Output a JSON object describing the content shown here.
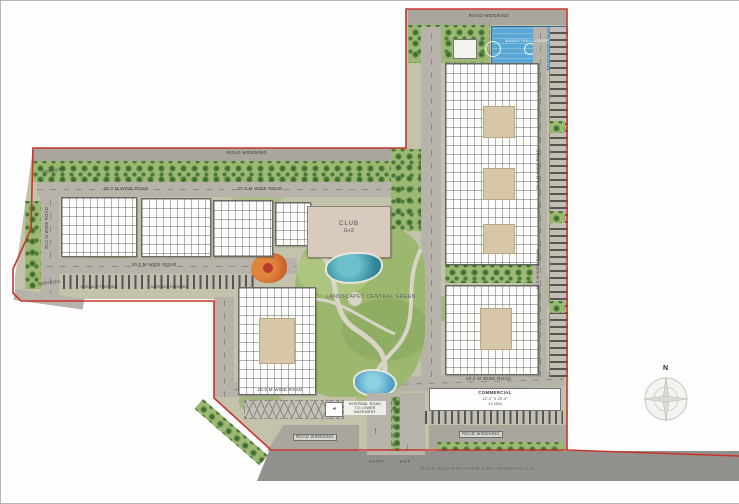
{
  "labels": {
    "road_widening_top": "ROAD WIDENING",
    "road_widening_left": "ROAD WIDENING",
    "road_widening_bottom_left": "ROAD WIDENING",
    "road_widening_bottom_right": "ROAD WIDENING",
    "road_widening_note": "ROAD WIDENING FROM SIDE OWNER'S LAND",
    "basketball_court": "BASKETBALL COURT",
    "services_top": "SERVICES",
    "services_bottom": "SERVICES",
    "club_name": "CLUB",
    "club_floors": "G+2",
    "central_green": "LANDSCAPED CENTRAL GREEN",
    "commercial_title": "COMMERCIAL",
    "commercial_size": "12'-0\" X 29'-0\"",
    "commercial_units": "12 NOs",
    "entry": "ENTRY",
    "exit": "EXIT",
    "internal_ramp_l1": "INTERNAL ROAD",
    "internal_ramp_l2": "TO LOWER",
    "internal_ramp_l3": "BASEMENT",
    "surface_parking_left": "SURFACE PARKING",
    "surface_parking_right": "SURFACE PARKING",
    "compass_north": "N"
  },
  "roads": {
    "top_left": "20.0 M WIDE ROAD",
    "top_center": "20.0 M WIDE ROAD",
    "middle": "20.0 M WIDE ROAD",
    "left_vertical": "20.0 M WIDE ROAD",
    "bottom_center": "20.0 M WIDE ROAD",
    "right_bottom": "20.0 M WIDE ROAD",
    "right_vertical_upper": "20.0 M WIDE ROAD",
    "right_vertical_lower": "20.0 M WIDE ROAD"
  },
  "colors": {
    "boundary": "#c5352c",
    "road": "#b7b3ab",
    "landscape_green": "#9cb76e",
    "water": "#2f8496",
    "court_blue": "#58a7d4",
    "building": "#fcfcfa",
    "courtyard": "#d7c6a7"
  }
}
